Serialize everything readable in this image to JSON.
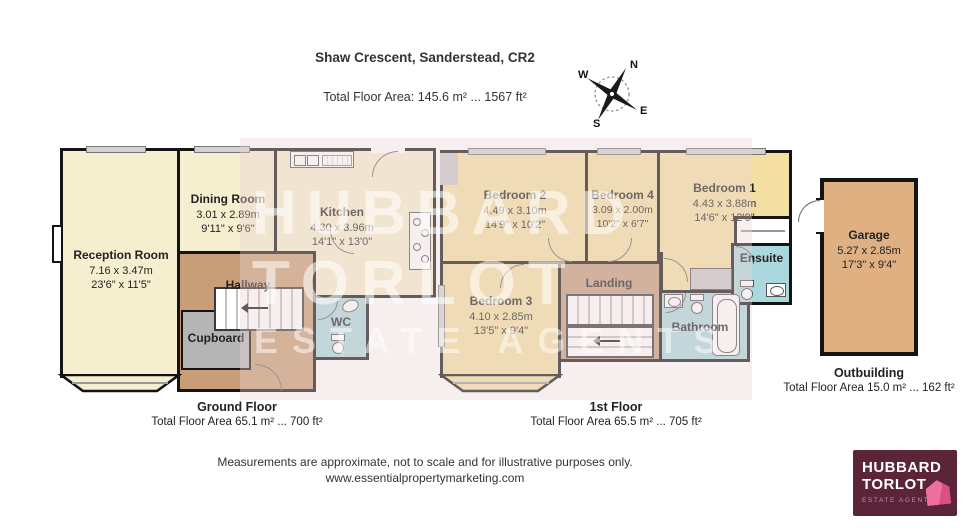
{
  "header": {
    "title": "Shaw Crescent, Sanderstead, CR2",
    "subtitle": "Total Floor Area: 145.6 m² ... 1567 ft²"
  },
  "compass": {
    "n": "N",
    "e": "E",
    "s": "S",
    "w": "W"
  },
  "watermark": {
    "line1": "HUBBARD",
    "line2": "TORLOT",
    "line3": "ESTATE AGENTS"
  },
  "ground": {
    "title": "Ground Floor",
    "area": "Total Floor Area 65.1 m² ... 700 ft²",
    "reception": {
      "name": "Reception Room",
      "metric": "7.16 x 3.47m",
      "imperial": "23'6\" x 11'5\""
    },
    "dining": {
      "name": "Dining Room",
      "metric": "3.01 x 2.89m",
      "imperial": "9'11\" x 9'6\""
    },
    "kitchen": {
      "name": "Kitchen",
      "metric": "4.30 x 3.96m",
      "imperial": "14'1\" x 13'0\""
    },
    "hallway": {
      "name": "Hallway"
    },
    "cupboard": {
      "name": "Cupboard"
    },
    "wc": {
      "name": "WC"
    }
  },
  "first": {
    "title": "1st Floor",
    "area": "Total Floor Area 65.5 m² ... 705 ft²",
    "bedroom1": {
      "name": "Bedroom 1",
      "metric": "4.43 x 3.88m",
      "imperial": "14'6\" x 12'9\""
    },
    "bedroom2": {
      "name": "Bedroom 2",
      "metric": "4.49 x 3.10m",
      "imperial": "14'9\" x 10'2\""
    },
    "bedroom3": {
      "name": "Bedroom 3",
      "metric": "4.10 x 2.85m",
      "imperial": "13'5\" x 9'4\""
    },
    "bedroom4": {
      "name": "Bedroom 4",
      "metric": "3.09 x 2.00m",
      "imperial": "10'2\" x 6'7\""
    },
    "landing": {
      "name": "Landing"
    },
    "bathroom": {
      "name": "Bathroom"
    },
    "ensuite": {
      "name": "Ensuite"
    }
  },
  "outbuilding": {
    "title": "Outbuilding",
    "area": "Total Floor Area 15.0 m² ... 162 ft²",
    "garage": {
      "name": "Garage",
      "metric": "5.27 x 2.85m",
      "imperial": "17'3\" x 9'4\""
    }
  },
  "footer": {
    "line1": "Measurements are approximate, not to scale and for illustrative purposes only.",
    "line2": "www.essentialpropertymarketing.com"
  },
  "logo": {
    "line1": "HUBBARD",
    "line2": "TORLOT",
    "tagline": "ESTATE AGENTS"
  },
  "colors": {
    "ground_room": "#f6efcf",
    "bedroom": "#f3dfa2",
    "hall": "#c89e78",
    "wet_room": "#abd7de",
    "cupboard": "#b5b5b5",
    "garage": "#deb082",
    "wall": "#141414",
    "logo_bg": "#5b2438",
    "logo_pink": "#ee6ea0"
  }
}
